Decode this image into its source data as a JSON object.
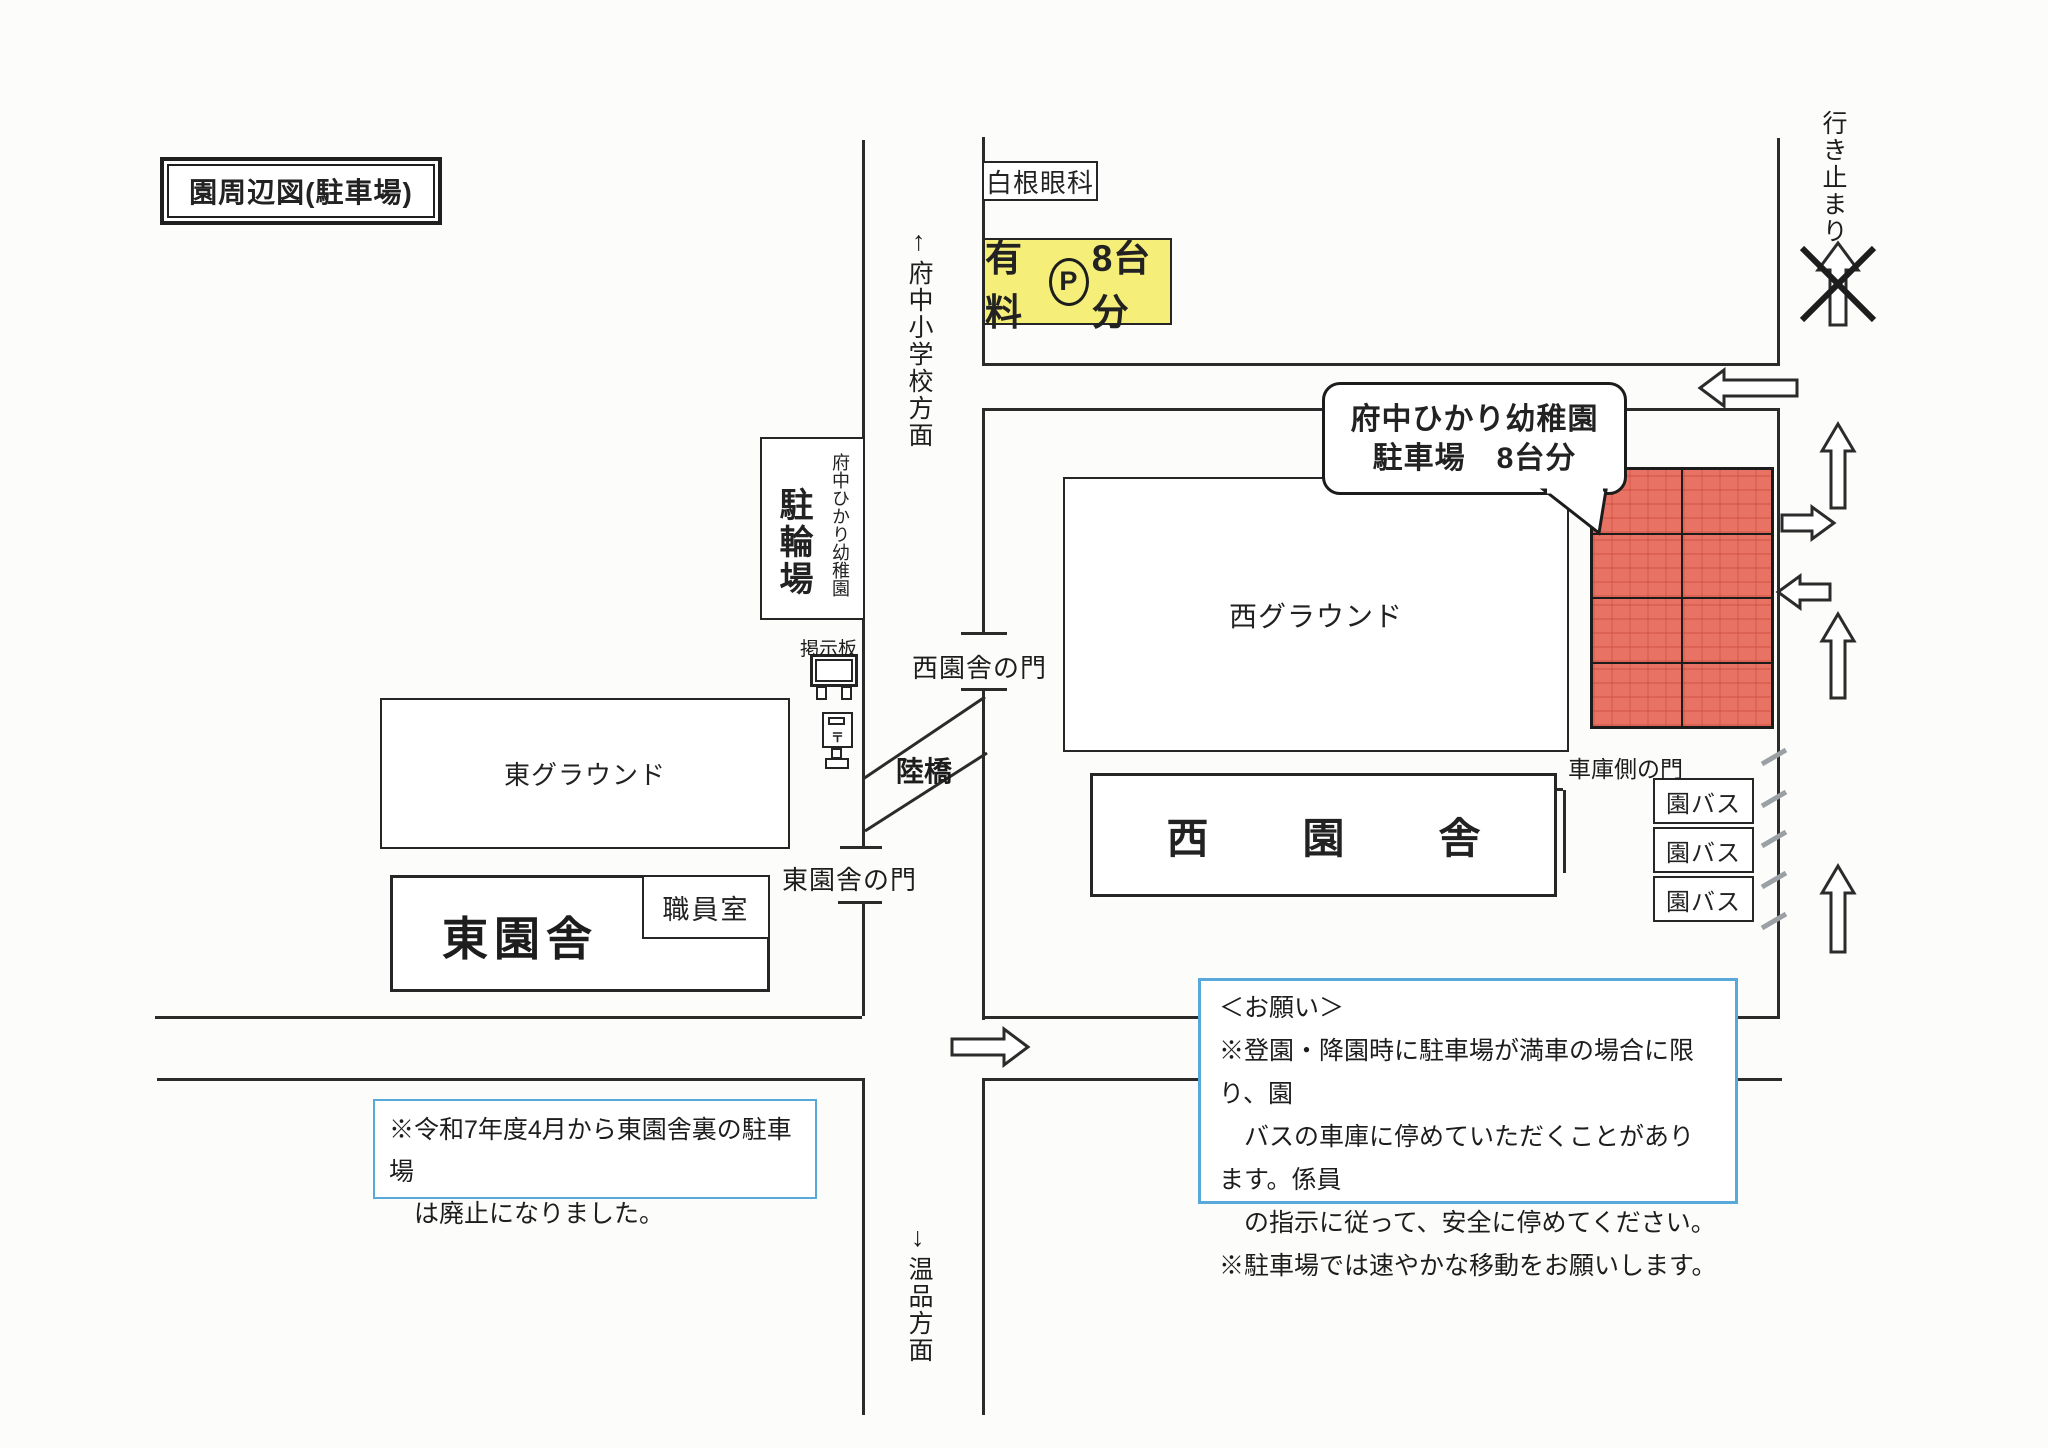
{
  "page": {
    "title": "園周辺図(駐車場)"
  },
  "directions": {
    "north_arrow": "↑",
    "north_text": "府中小学校方面",
    "south_arrow": "↓",
    "south_text": "温品方面",
    "dead_end_text": "行き止まり"
  },
  "buildings": {
    "eye_clinic": "白根眼科",
    "paid_parking": {
      "prefix": "有料",
      "p": "P",
      "suffix": "8台分"
    },
    "bicycle_parking": {
      "small": "府中ひかり幼稚園",
      "large": "駐輪場"
    },
    "bulletin_board": "掲示板",
    "post_mark": "〒",
    "east_ground": "東グラウンド",
    "east_building": "東園舎",
    "staff_room": "職員室",
    "west_ground": "西グラウンド",
    "west_building": "西　園　舎"
  },
  "gates": {
    "west_gate": "西園舎の門",
    "east_gate": "東園舎の門",
    "garage_gate": "車庫側の門"
  },
  "bridge": "陸橋",
  "callout": {
    "line1": "府中ひかり幼稚園",
    "line2": "駐車場　8台分"
  },
  "garage": {
    "bus_labels": [
      "園バス",
      "園バス",
      "園バス"
    ]
  },
  "parking": {
    "spaces": 8,
    "fill_color": "#e87263"
  },
  "notes": {
    "abolished": {
      "line1": "※令和7年度4月から東園舎裏の駐車場",
      "line2": "　は廃止になりました。"
    },
    "request": {
      "title": "＜お願い＞",
      "line1": "※登園・降園時に駐車場が満車の場合に限り、園",
      "line2": "　バスの車庫に停めていただくことがあります。係員",
      "line3": "　の指示に従って、安全に停めてください。",
      "line4": "※駐車場では速やかな移動をお願いします。"
    }
  },
  "colors": {
    "paid_parking_fill": "#f5ef7a",
    "parking_fill": "#e87263",
    "note_border": "#58a9d9",
    "line": "#2b2b2b"
  }
}
